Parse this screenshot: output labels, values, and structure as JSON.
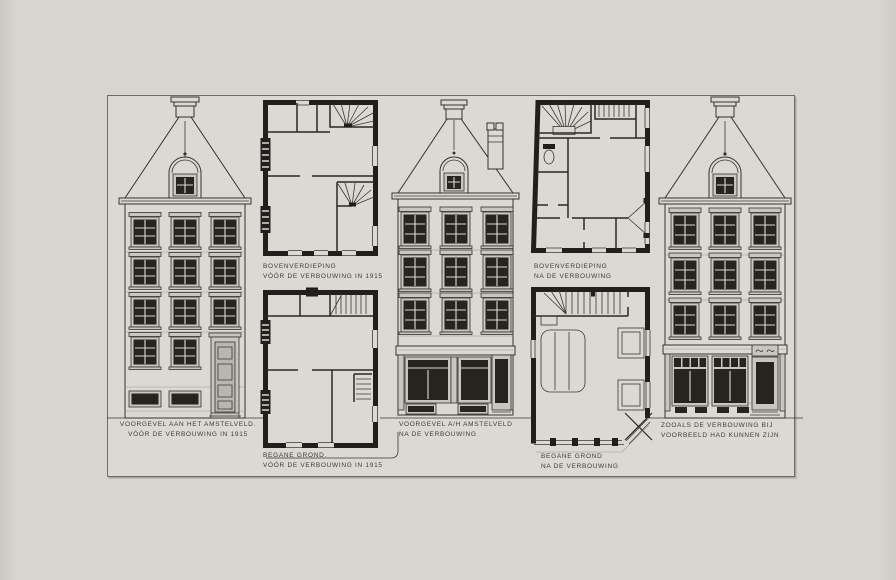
{
  "palette": {
    "background": "#d7d4d0",
    "paper": "#dcd9d4",
    "ink": "#34322e",
    "wall_black": "#211f1c",
    "glass_dark": "#26241f",
    "caption_text": "#3e3c38"
  },
  "figures": {
    "facade_before": {
      "caption": [
        "VOORGEVEL AAN HET AMSTELVELD.",
        "VÓÓR DE VERBOUWING IN 1915"
      ]
    },
    "upper_floor_before": {
      "caption": [
        "BOVENVERDIEPING",
        "VÓÓR DE VERBOUWING IN 1915"
      ]
    },
    "ground_floor_before": {
      "caption": [
        "BEGANE GROND.",
        "VÓÓR DE VERBOUWING IN 1915"
      ]
    },
    "facade_after": {
      "caption": [
        "VOORGEVEL A/H AMSTELVELD",
        "NA DE VERBOUWING"
      ]
    },
    "upper_floor_after": {
      "caption": [
        "BOVENVERDIEPING",
        "NA DE VERBOUWING"
      ]
    },
    "ground_floor_after": {
      "caption": [
        "BEGANE GROND",
        "NA DE VERBOUWING"
      ]
    },
    "facade_proposed": {
      "caption": [
        "ZOOALS DE VERBOUWING BIJ",
        "VOORBEELD HAD KUNNEN ZIJN"
      ]
    }
  }
}
